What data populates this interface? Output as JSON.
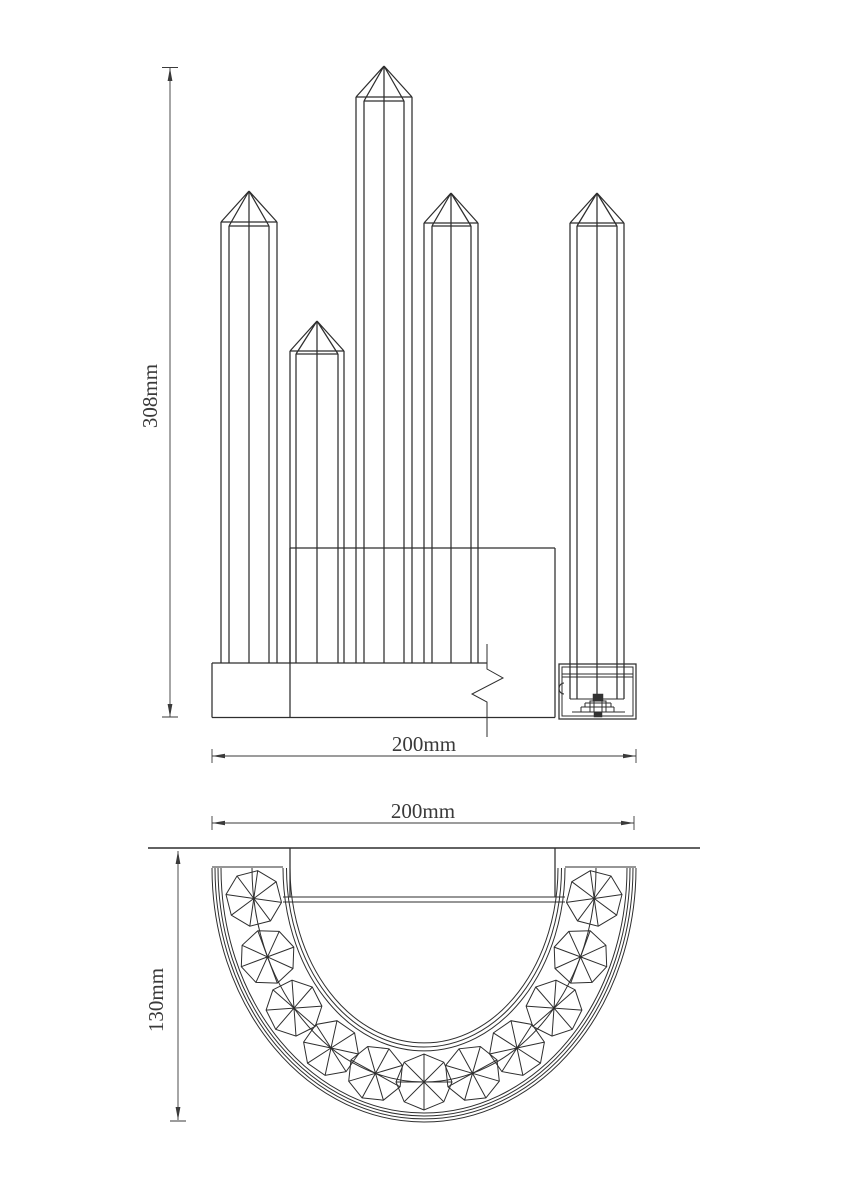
{
  "views": {
    "front": {
      "height_dim": "308mm",
      "width_dim": "200mm",
      "rod_count": 5
    },
    "bottom": {
      "width_dim": "200mm",
      "depth_dim": "130mm",
      "crystal_count": 11
    }
  },
  "colors": {
    "background": "#ffffff",
    "line": "#2e2e2e",
    "dim_text": "#3a3a3a"
  }
}
